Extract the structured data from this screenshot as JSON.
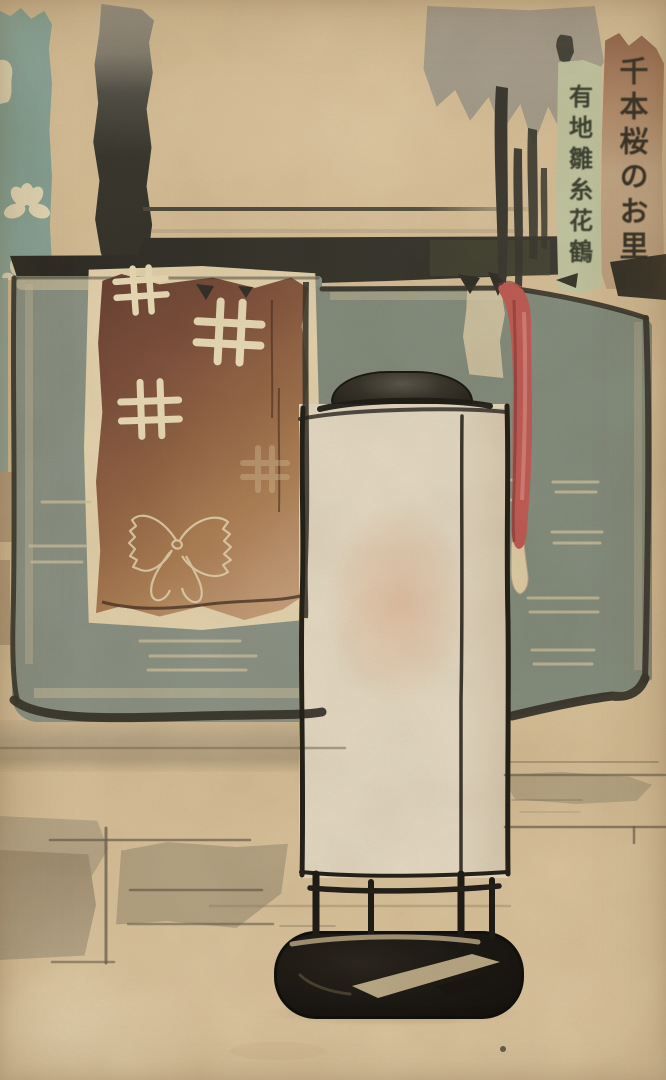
{
  "artwork": {
    "description": "Watercolor woodblock print: paper lantern (andon) on black stand before green folding screens, draped brown textile with well-crib motifs, hanging red ribbon, calligraphy cartouches",
    "cartouches": {
      "right_text": "千本桜のお里",
      "left_text": "有地雛糸花鶴"
    },
    "motifs": [
      "sakura-blossom",
      "igeta-well-crib",
      "butterfly-leaf"
    ],
    "palette": {
      "paper": "#d9c29b",
      "ink": "#26231c",
      "screen_green": "#8c9487",
      "textile_brown": "#6a4234",
      "textile_tan": "#caa57e",
      "ribbon_red": "#c25e57",
      "lantern_cream": "#e8ddc8",
      "lantern_glow": "#db9f78",
      "teal_panel": "#8fab9f",
      "cartouche_green": "#c5c9a5",
      "cartouche_tan": "#c2a483",
      "motif_cream": "#ecdfba"
    }
  }
}
